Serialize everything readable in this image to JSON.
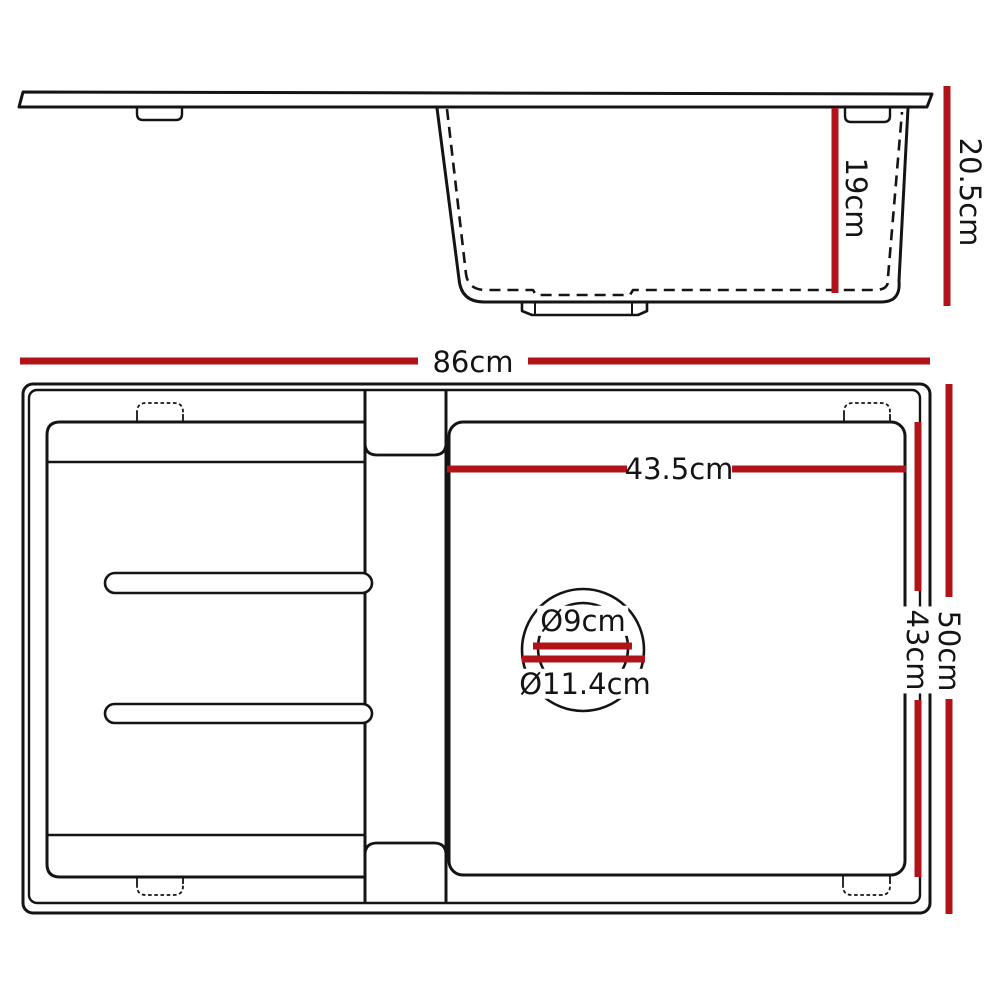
{
  "palette": {
    "line_color": "#141414",
    "dimension_color": "#b11418",
    "background": "#ffffff"
  },
  "side_view": {
    "labels": {
      "bowl_depth": "19cm",
      "overall_depth": "20.5cm"
    }
  },
  "plan_view": {
    "labels": {
      "overall_width": "86cm",
      "bowl_width": "43.5cm",
      "bowl_length": "43cm",
      "overall_length": "50cm",
      "drain_inner_diameter": "Ø9cm",
      "drain_outer_diameter": "Ø11.4cm"
    }
  }
}
